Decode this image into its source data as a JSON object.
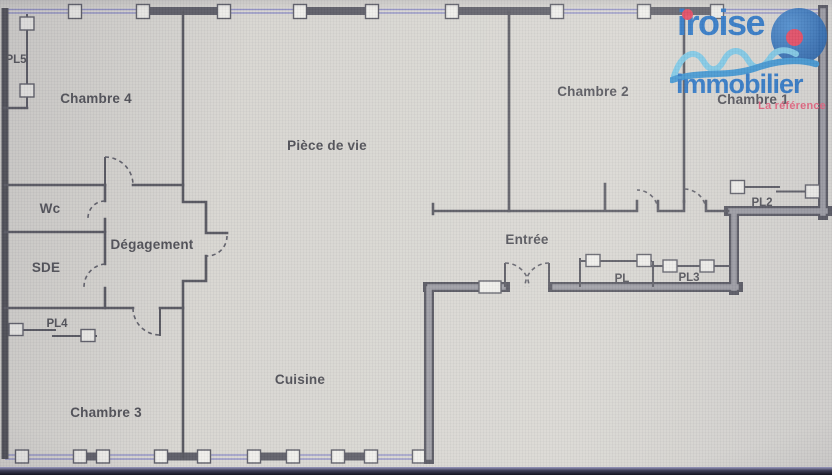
{
  "logo": {
    "name": "iroise",
    "name2": "immobilier",
    "tagline": "La référence",
    "colors": {
      "brand_blue": "#1a6cc4",
      "accent_red": "#e63a55",
      "wave_light": "#74c7e8",
      "wave_dark": "#2f8fd2",
      "circle_blue": "#1c5ca8",
      "tagline_pink": "#e55573"
    }
  },
  "plan": {
    "rooms": [
      {
        "label": "Chambre 4"
      },
      {
        "label": "Pièce de vie"
      },
      {
        "label": "Chambre 2"
      },
      {
        "label": "Chambre 1"
      },
      {
        "label": "Wc"
      },
      {
        "label": "Dégagement"
      },
      {
        "label": "SDE"
      },
      {
        "label": "Chambre 3"
      },
      {
        "label": "Cuisine"
      },
      {
        "label": "Entrée"
      }
    ],
    "closets": [
      {
        "label": "PL5"
      },
      {
        "label": "PL4"
      },
      {
        "label": "PL"
      },
      {
        "label": "PL3"
      },
      {
        "label": "PL2"
      }
    ],
    "colors": {
      "wall": "#52525b",
      "thick_wall_fill": "#97979f",
      "window_wall_purple": "#9191c4",
      "floor": "#d7d5d0",
      "label_text": "#494950"
    }
  }
}
